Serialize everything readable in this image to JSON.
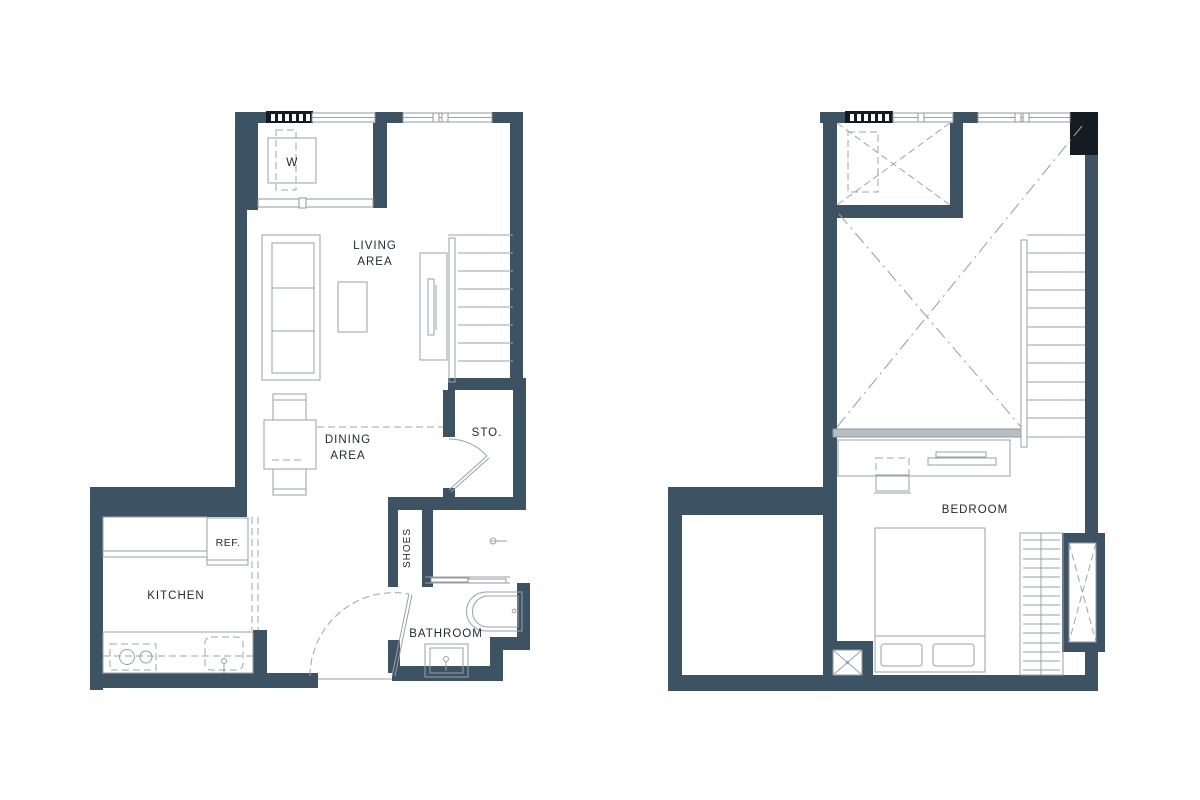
{
  "page": {
    "background": "#ffffff"
  },
  "colors": {
    "wall": "#3d5262",
    "column_black": "#141b21",
    "furniture_line": "#98a2aa",
    "dashed_line": "#9aa5ac",
    "railing_fill": "#b7bec4",
    "label_text": "#242a30",
    "background": "#ffffff"
  },
  "plans": [
    {
      "name": "lower-floor-plan",
      "labels": {
        "washer": "W",
        "living_line1": "LIVING",
        "living_line2": "AREA",
        "dining_line1": "DINING",
        "dining_line2": "AREA",
        "storage": "STO.",
        "shoes": "SHOES",
        "fridge": "REF.",
        "kitchen": "KITCHEN",
        "bathroom": "BATHROOM"
      }
    },
    {
      "name": "upper-floor-plan",
      "labels": {
        "bedroom": "BEDROOM"
      }
    }
  ]
}
